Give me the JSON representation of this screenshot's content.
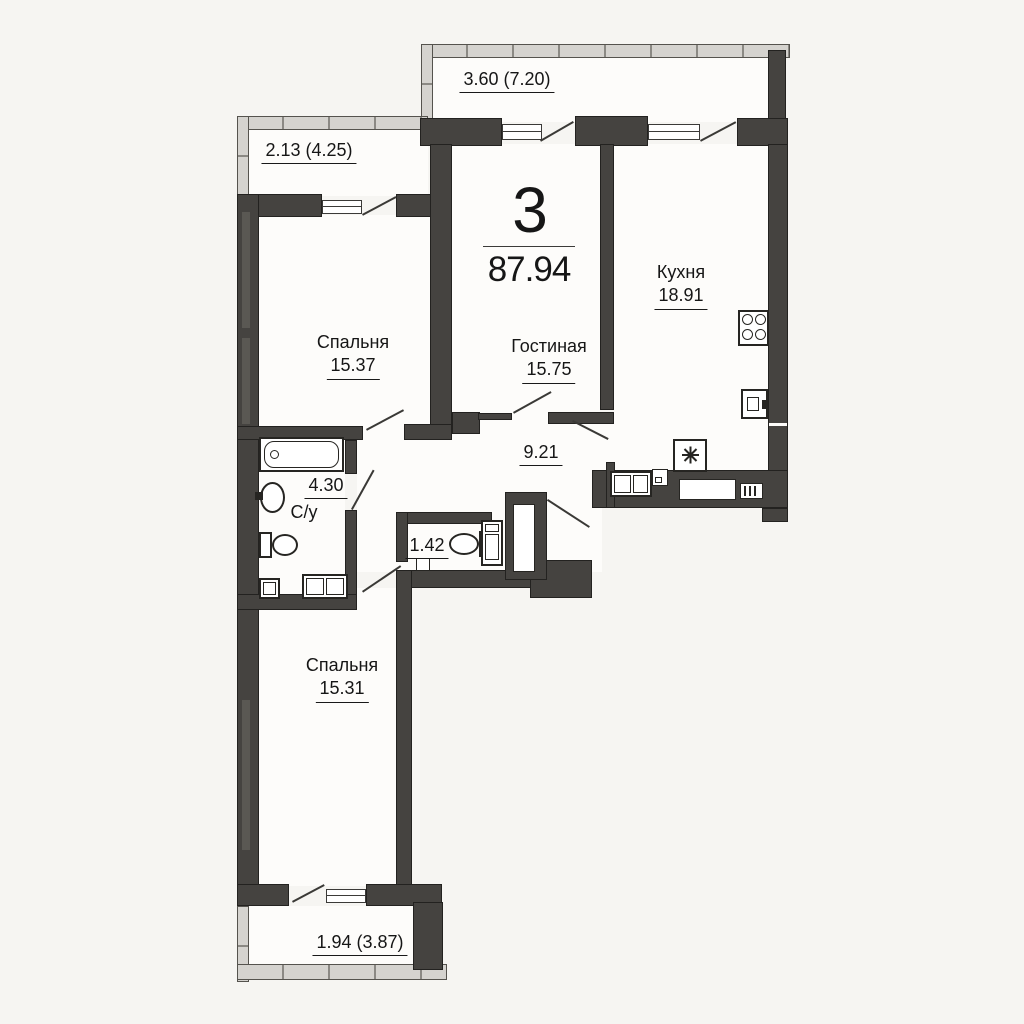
{
  "apartment": {
    "rooms_count": "3",
    "total_area": "87.94"
  },
  "rooms": {
    "kitchen": {
      "name": "Кухня",
      "area": "18.91"
    },
    "living": {
      "name": "Гостиная",
      "area": "15.75"
    },
    "bedroom_top": {
      "name": "Спальня",
      "area": "15.37"
    },
    "bedroom_bottom": {
      "name": "Спальня",
      "area": "15.31"
    },
    "bathroom": {
      "name": "С/у",
      "area": "4.30"
    },
    "wc": {
      "area": "1.42"
    },
    "hallway": {
      "area": "9.21"
    }
  },
  "balconies": {
    "top": {
      "label": "3.60 (7.20)"
    },
    "left": {
      "label": "2.13 (4.25)"
    },
    "bottom": {
      "label": "1.94 (3.87)"
    }
  },
  "icons": {
    "bathtub": "tub-with-drain",
    "sink": "oval-basin",
    "toilet": "tank-and-bowl",
    "washing_machine": "square-in-square",
    "stove": "four-burners",
    "fridge": "snowflake",
    "ventilation_shaft": "slot-in-wall",
    "electrical_panel": "bars-in-wall"
  },
  "colors": {
    "wall": "#454340",
    "railing": "#d5d3cf",
    "floor": "#fdfcfa",
    "background": "#f6f5f2",
    "text": "#161616"
  }
}
